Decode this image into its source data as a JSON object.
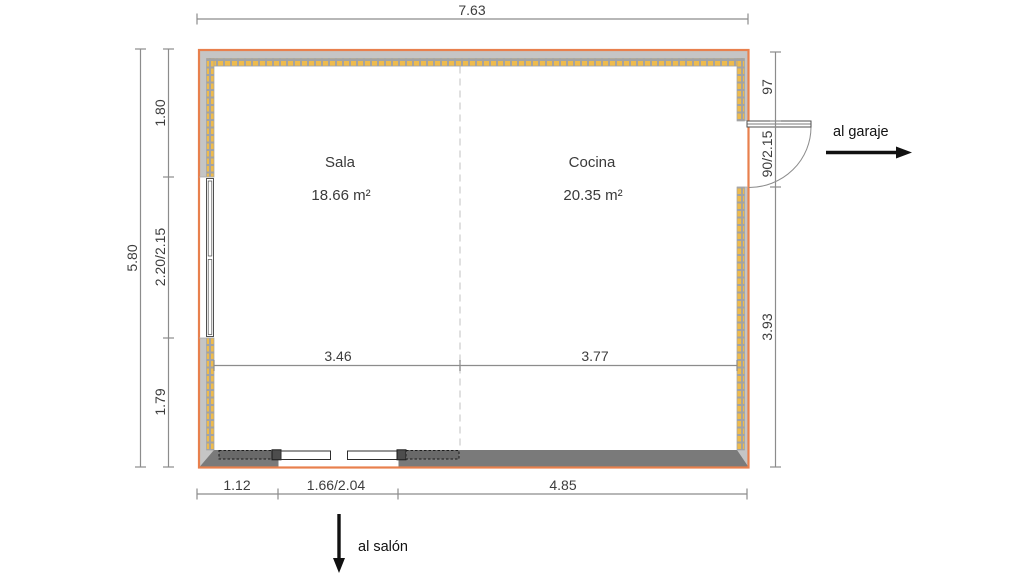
{
  "plan": {
    "rooms": [
      {
        "name": "Sala",
        "area": "18.66 m²"
      },
      {
        "name": "Cocina",
        "area": "20.35 m²"
      }
    ],
    "dimensions": {
      "top_total": "7.63",
      "left_total": "5.80",
      "left_segments": [
        "1.80",
        "2.20/2.15",
        "1.79"
      ],
      "right_segments": [
        "97",
        "90/2.15",
        "3.93"
      ],
      "bottom_segments": [
        "1.12",
        "1.66/2.04",
        "4.85"
      ],
      "interior_segments": [
        "3.46",
        "3.77"
      ]
    },
    "annotations": {
      "garage": "al garaje",
      "salon": "al salón"
    },
    "colors": {
      "wall_outline": "#e8804d",
      "wall_fill": "#c5c5c5",
      "wall_bottom_fill": "#7a7a7a",
      "hatch_yellow": "#eebb4d",
      "hatch_grid": "#a3a3a3",
      "fixture_stroke": "#4f4f4f",
      "dimension_line": "#8c8c8c",
      "dimension_text": "#3d3d3d",
      "room_text": "#3a3a3a",
      "divider_dash": "#d8d8d8",
      "arrow_black": "#111111"
    }
  }
}
